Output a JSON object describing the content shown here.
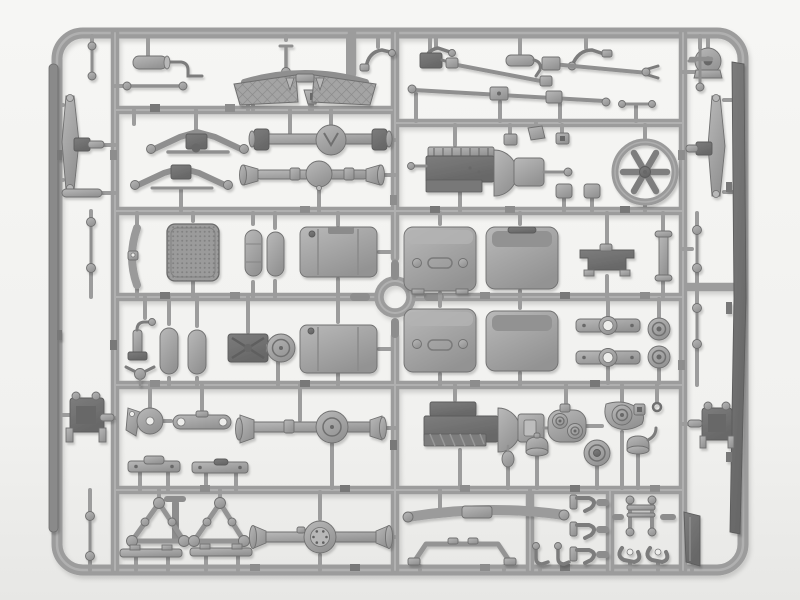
{
  "meta": {
    "type": "photograph",
    "subject": "Gray injection-molded plastic model kit sprue (parts tree) with military truck chassis components on a white studio background",
    "orientation": "landscape",
    "text_visible": "none"
  },
  "palette": {
    "bg_top": "#f6f6f4",
    "bg_mid": "#f1f1ef",
    "bg_bottom": "#e7e7e5",
    "sprue": "#9c9c9c",
    "sprue_hi": "#bcbcbc",
    "edge": "#6f6f6f",
    "plastic_light": "#b9b9b9",
    "plastic_mid": "#939393",
    "plastic_dark": "#7d7d7d",
    "plastic_deep": "#676767",
    "tab": "#8d8d8d",
    "tab2": "#787878",
    "hole": "#ededeb"
  },
  "sprue": {
    "frame": "rounded rectangular outer runner",
    "grid": "three full-height vertical runners and five horizontal runners dividing the tree into part cells",
    "center_feature": "circular locating ring at the runner crossing in the middle",
    "parts": [
      {
        "id": "muffler-with-pipe",
        "label": "muffler with exhaust pipe"
      },
      {
        "id": "tie-rod-small",
        "label": "short tie rod with ball ends"
      },
      {
        "id": "steering-link",
        "label": "steering link"
      },
      {
        "id": "pedal-bracket-a",
        "label": "pedal bracket"
      },
      {
        "id": "pedal-bracket-b",
        "label": "pedal bracket"
      },
      {
        "id": "clutch-lever",
        "label": "bent lever"
      },
      {
        "id": "brake-lever",
        "label": "bent lever with ball"
      },
      {
        "id": "hose-bracket",
        "label": "cylinder with hooked bracket"
      },
      {
        "id": "bell-crank-lever",
        "label": "crank lever"
      },
      {
        "id": "blower-housing",
        "label": "round blower housing"
      },
      {
        "id": "running-boards",
        "label": "pair of curved running boards with tread-plate texture"
      },
      {
        "id": "steering-box",
        "label": "steering gearbox with pitman arm"
      },
      {
        "id": "drive-shaft-a",
        "label": "drive shaft"
      },
      {
        "id": "drive-shaft-b",
        "label": "drive shaft with yoke"
      },
      {
        "id": "drive-shaft-long",
        "label": "long propeller shaft with two U-joints"
      },
      {
        "id": "stabilizer-link",
        "label": "stabilizer link"
      },
      {
        "id": "t-handle-rod",
        "label": "rod with cross handle"
      },
      {
        "id": "leaf-spring-a",
        "label": "leaf spring"
      },
      {
        "id": "leaf-spring-b",
        "label": "leaf spring"
      },
      {
        "id": "front-axle-1",
        "label": "front axle housing with differential"
      },
      {
        "id": "rear-axle-1",
        "label": "rear axle housing with ball differential"
      },
      {
        "id": "engine-block-a",
        "label": "engine block with bell housing and gearbox"
      },
      {
        "id": "mount-blocks",
        "label": "three small mount blocks"
      },
      {
        "id": "engine-pads",
        "label": "two square mounting pads"
      },
      {
        "id": "cooling-fan",
        "label": "six-blade cooling fan inside round shroud"
      },
      {
        "id": "radiator-core",
        "label": "radiator with mesh core"
      },
      {
        "id": "fender-brace",
        "label": "curved brace strip"
      },
      {
        "id": "air-tank-a",
        "label": "cylindrical air tank"
      },
      {
        "id": "air-tank-b",
        "label": "cylindrical air tank"
      },
      {
        "id": "air-tank-c",
        "label": "cylindrical air tank"
      },
      {
        "id": "air-tank-d",
        "label": "cylindrical air tank"
      },
      {
        "id": "fuel-tank-a",
        "label": "large fuel tank"
      },
      {
        "id": "fuel-tank-b",
        "label": "large fuel tank"
      },
      {
        "id": "toolbox-a",
        "label": "stowage box with latches"
      },
      {
        "id": "toolbox-b",
        "label": "stowage box"
      },
      {
        "id": "toolbox-c",
        "label": "stowage box with latches"
      },
      {
        "id": "toolbox-d",
        "label": "stowage box"
      },
      {
        "id": "seat-bracket",
        "label": "stepped seat base bracket"
      },
      {
        "id": "flat-bar-part",
        "label": "flat bar with end caps"
      },
      {
        "id": "pivot-arm",
        "label": "pivot arm"
      },
      {
        "id": "wing-nut",
        "label": "winged fastener"
      },
      {
        "id": "engine-mount-drum",
        "label": "cross-braced mount with round drum"
      },
      {
        "id": "spring-seat-a",
        "label": "spring seat bracket with center hole"
      },
      {
        "id": "spring-seat-b",
        "label": "spring seat bracket with center hole"
      },
      {
        "id": "brake-drum-a",
        "label": "brake drum disc"
      },
      {
        "id": "brake-drum-b",
        "label": "brake drum disc"
      },
      {
        "id": "bell-crank-disc",
        "label": "bell crank with disc"
      },
      {
        "id": "drag-link",
        "label": "flat drag link"
      },
      {
        "id": "front-axle-2",
        "label": "front axle housing with round differential"
      },
      {
        "id": "mount-bar-a",
        "label": "mounting bar"
      },
      {
        "id": "mount-bar-b",
        "label": "mounting bar"
      },
      {
        "id": "engine-block-b",
        "label": "second engine block with ribbed sump"
      },
      {
        "id": "shift-knob",
        "label": "pear-shaped knob"
      },
      {
        "id": "transfer-case-a",
        "label": "transfer case with twin bosses"
      },
      {
        "id": "transfer-case-b",
        "label": "transfer case with large boss"
      },
      {
        "id": "small-ring",
        "label": "small ring"
      },
      {
        "id": "air-filter-pot-a",
        "label": "domed filter pot"
      },
      {
        "id": "air-filter-pot-b",
        "label": "domed filter pot with pipe"
      },
      {
        "id": "pulley-wheel",
        "label": "grooved pulley wheel"
      },
      {
        "id": "frame-triangle-a",
        "label": "triangular frame brace"
      },
      {
        "id": "frame-triangle-b",
        "label": "triangular frame brace"
      },
      {
        "id": "step-plate-a",
        "label": "step plate bar"
      },
      {
        "id": "step-plate-b",
        "label": "step plate bar"
      },
      {
        "id": "rear-axle-2",
        "label": "rear axle housing with bolted cover"
      },
      {
        "id": "front-bumper",
        "label": "long curved bumper bar"
      },
      {
        "id": "tow-hook-1",
        "label": "tow hook"
      },
      {
        "id": "tow-hook-2",
        "label": "tow hook"
      },
      {
        "id": "tow-hook-3",
        "label": "tow hook"
      },
      {
        "id": "tube-frame-h",
        "label": "H-shaped tube frame"
      },
      {
        "id": "shackle-a",
        "label": "shackle"
      },
      {
        "id": "shackle-b",
        "label": "shackle"
      },
      {
        "id": "stowage-plate",
        "label": "dark angled plate"
      },
      {
        "id": "cab-bracket",
        "label": "wide support bracket"
      },
      {
        "id": "micro-hook-a",
        "label": "small hook"
      },
      {
        "id": "micro-hook-b",
        "label": "small hook"
      },
      {
        "id": "leaf-spring-left",
        "label": "leaf spring molded along left rail"
      },
      {
        "id": "leaf-spring-right",
        "label": "leaf spring molded along right rail"
      },
      {
        "id": "chassis-rail-left",
        "label": "long chassis rail along left frame"
      },
      {
        "id": "chassis-rail-right",
        "label": "long chassis rail along right frame"
      },
      {
        "id": "spring-hanger-left",
        "label": "spring hanger bracket"
      },
      {
        "id": "spring-hanger-right",
        "label": "spring hanger bracket"
      },
      {
        "id": "ball-rod-left-top",
        "label": "link rod with ball ends"
      },
      {
        "id": "ball-rod-left-mid",
        "label": "link rod with ball ends"
      },
      {
        "id": "ball-rod-left-bottom",
        "label": "link rod with ball ends"
      },
      {
        "id": "ball-rod-right-1",
        "label": "link rod with ball ends"
      },
      {
        "id": "ball-rod-right-2",
        "label": "link rod with ball ends"
      },
      {
        "id": "tie-capsule-left",
        "label": "small capsule tie"
      },
      {
        "id": "center-ring",
        "label": "central locating ring"
      }
    ]
  }
}
